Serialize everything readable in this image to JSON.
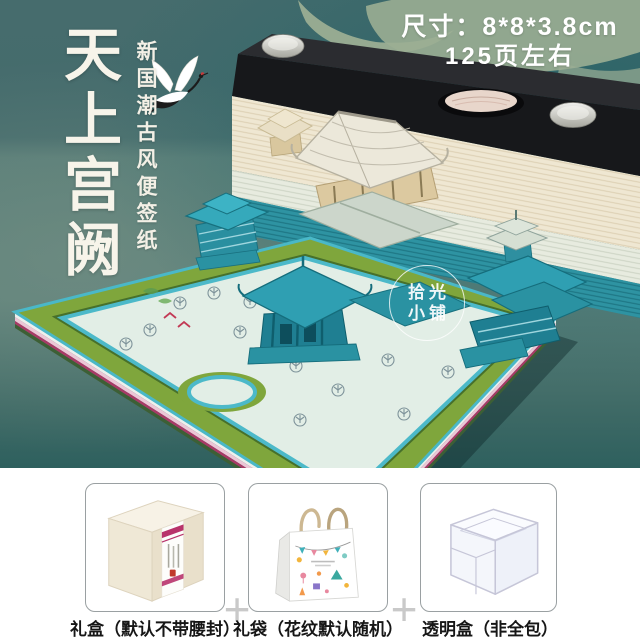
{
  "hero": {
    "title": "天上宫阙",
    "subtitle": "新国潮古风便签纸",
    "size_line1": "尺寸：8*8*3.8cm",
    "size_line2": "125页左右",
    "watermark_line1": "拾光",
    "watermark_line2": "小铺"
  },
  "options": {
    "separator": "+",
    "items": [
      {
        "name": "gift-box",
        "label": "礼盒（默认不带腰封）"
      },
      {
        "name": "gift-bag",
        "label": "礼袋（花纹默认随机）"
      },
      {
        "name": "clear-box",
        "label": "透明盒（非全包）"
      }
    ]
  },
  "colors": {
    "background_teal": "#23646a",
    "background_sage": "#7d9484",
    "lid_black": "#17181b",
    "pages_cream": "#efe7d2",
    "pages_teal": "#2e93a2",
    "building_teal": "#2f9fb2",
    "roof_white": "#ece8da",
    "courtyard_green": "#7fa63c",
    "courtyard_floor": "#e2eee6",
    "accent_pink": "#b8336b",
    "bird_red": "#c23a55"
  }
}
